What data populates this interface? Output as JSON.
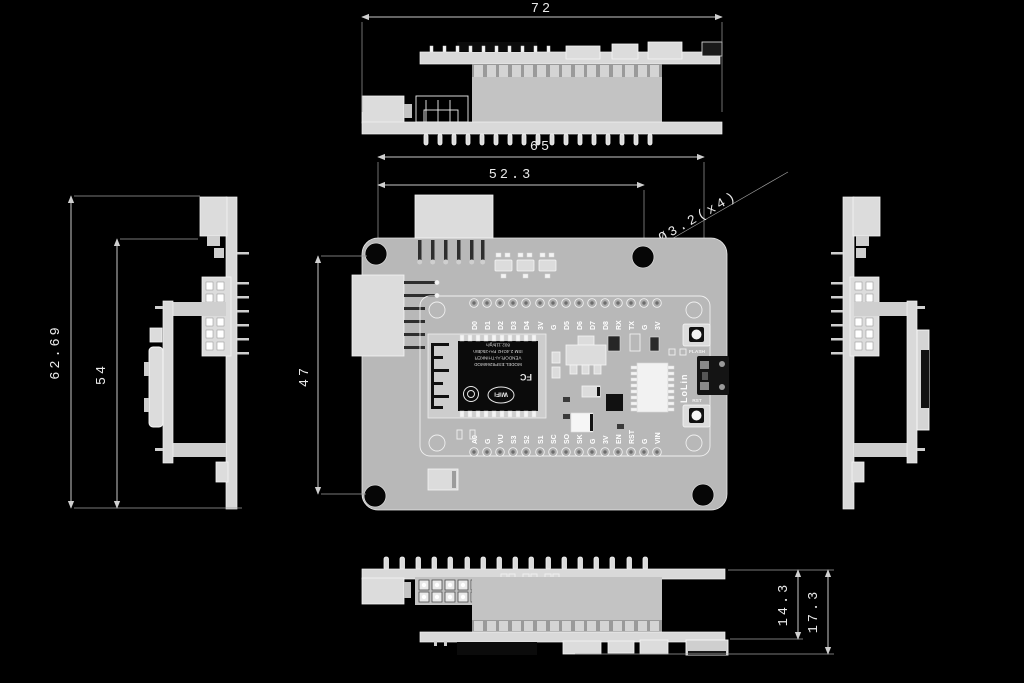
{
  "colors": {
    "background": "#000000",
    "board_gray": "#b8b8b8",
    "dim_line": "#c9c9c9",
    "dim_text": "#e9e9e9",
    "silkscreen": "#ffffff",
    "shield_black": "#0b0b0b"
  },
  "dimensions": {
    "overall_width": "72",
    "board_width": "65",
    "hole_spacing_x": "52.3",
    "hole_callout": "Ø3.2(x4)",
    "overall_height": "62.69",
    "board_height": "54",
    "hole_spacing_y": "47",
    "stack_height": "14.3",
    "overall_thickness": "17.3"
  },
  "plan": {
    "pins_top": [
      "D0",
      "D1",
      "D2",
      "D3",
      "D4",
      "3V",
      "G",
      "D5",
      "D6",
      "D7",
      "D8",
      "RX",
      "TX",
      "G",
      "3V"
    ],
    "pins_bottom": [
      "A0",
      "G",
      "VU",
      "S3",
      "S2",
      "S1",
      "SC",
      "SO",
      "SK",
      "G",
      "3V",
      "EN",
      "RST",
      "G",
      "VIN"
    ],
    "buttons": {
      "flash": "FLASH",
      "rst": "RST"
    },
    "brand": "LoLin",
    "module": {
      "fc": "FC",
      "wifi": "WiFi",
      "line1": "MODEL:ESP8266MOD",
      "line2": "VENDOR:AI-THINKER",
      "line3": "ISM 2.4GHz PA+25dBm",
      "line4": "802.11b/g/n"
    }
  }
}
